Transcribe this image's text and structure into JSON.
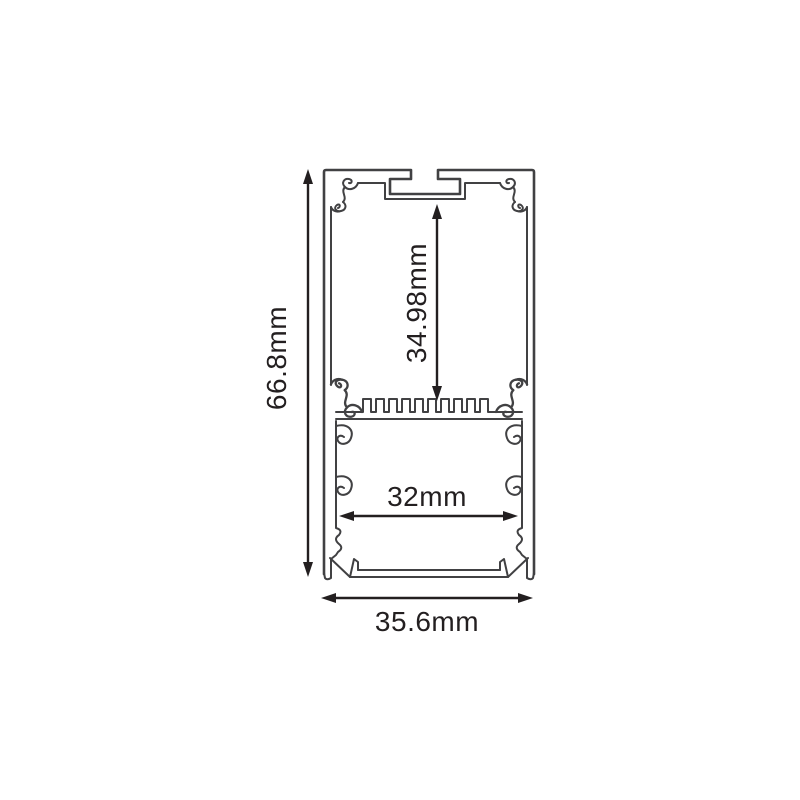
{
  "diagram": {
    "colors": {
      "background": "#ffffff",
      "profile_line": "#414143",
      "dimension_line": "#231f20",
      "text": "#231f20"
    },
    "labels": {
      "overall_height": "66.8mm",
      "overall_width": "35.6mm",
      "cavity_height": "34.98mm",
      "cavity_width": "32mm"
    }
  }
}
